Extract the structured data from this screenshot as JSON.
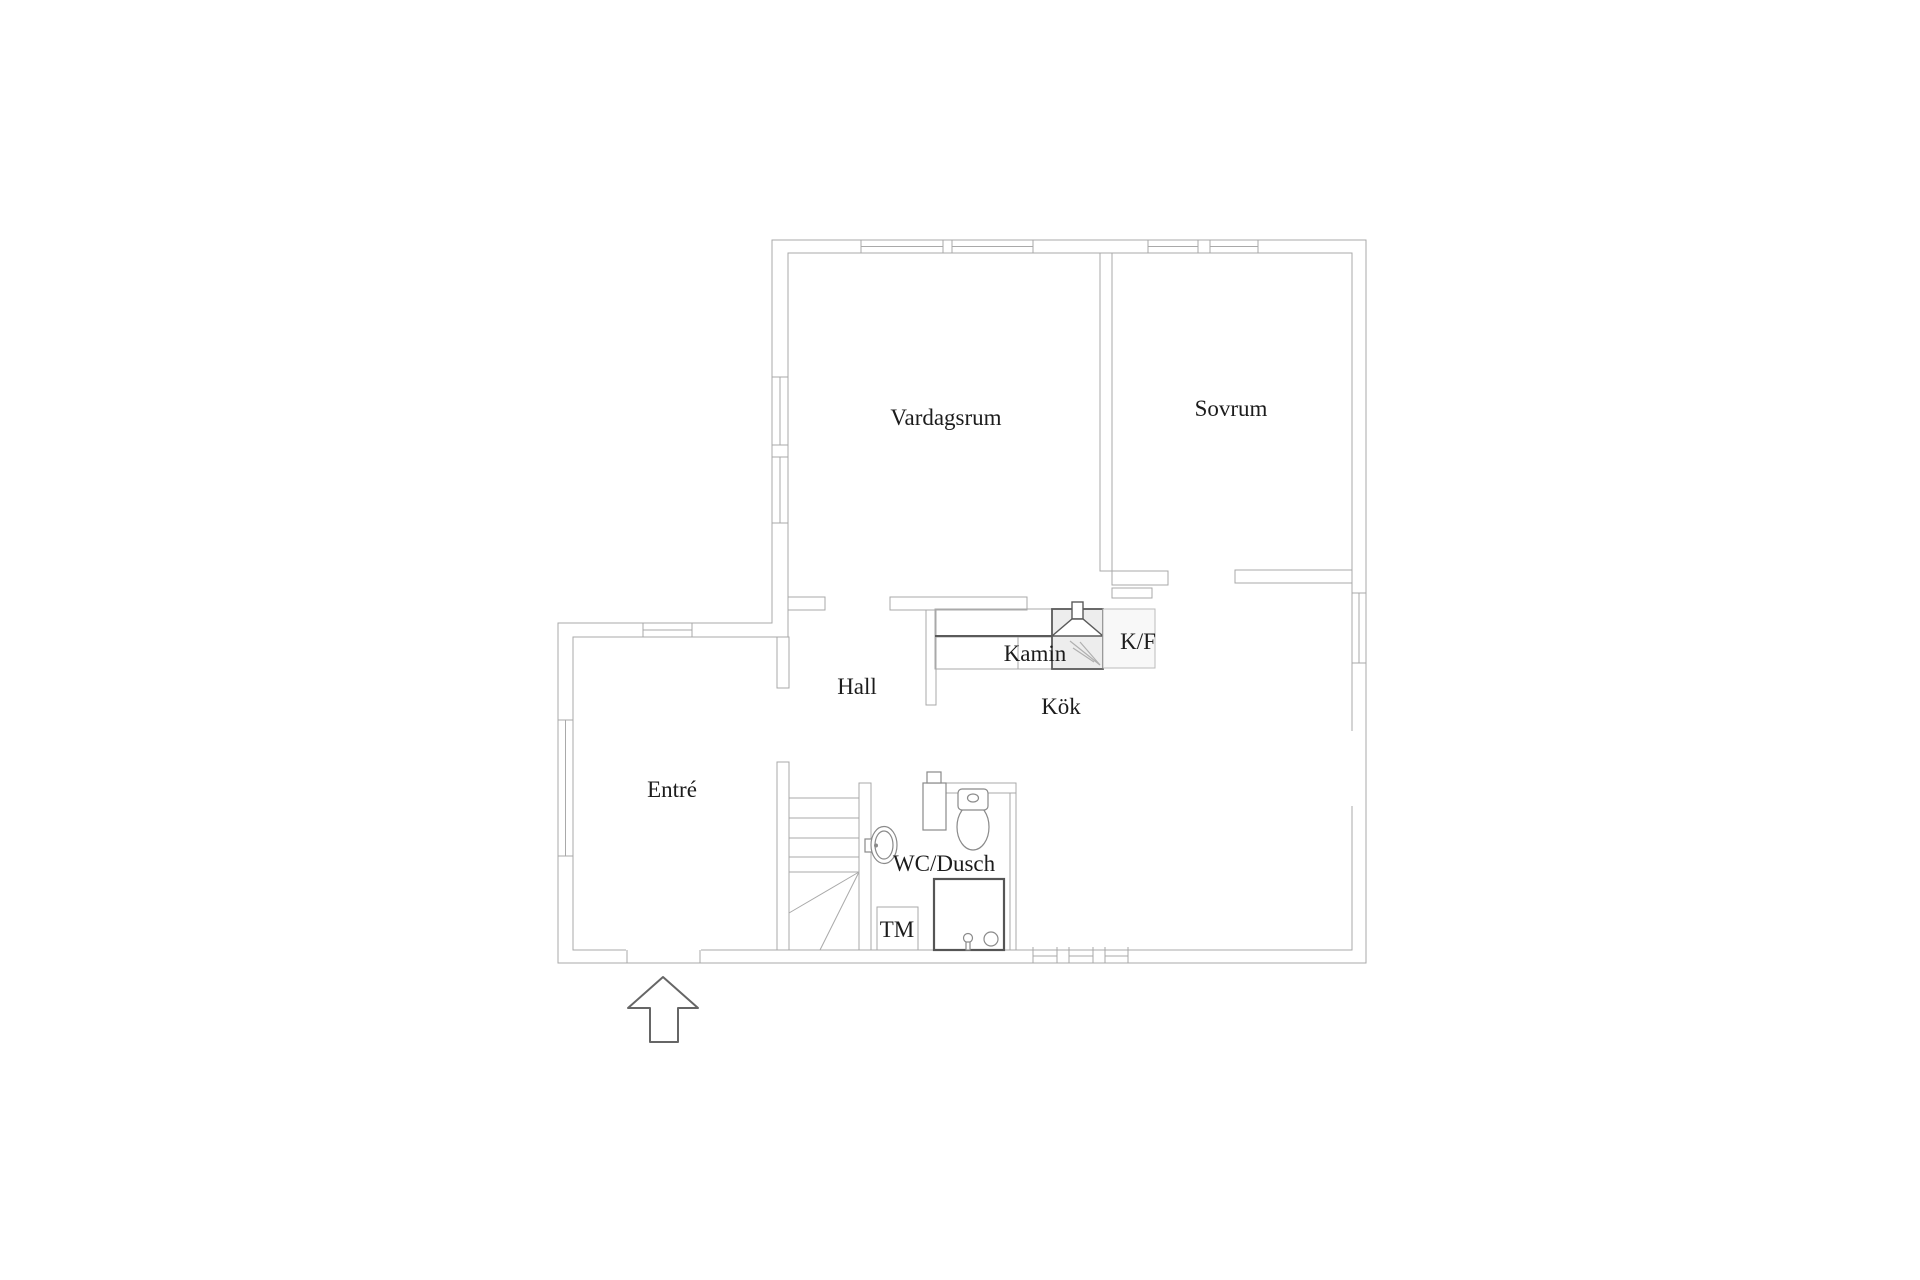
{
  "floorplan": {
    "labels": {
      "vardagsrum": "Vardagsrum",
      "sovrum": "Sovrum",
      "hall": "Hall",
      "kok": "Kök",
      "entre": "Entré",
      "wc_dusch": "WC/Dusch",
      "kamin": "Kamin",
      "kf": "K/F",
      "tm": "TM"
    },
    "entrance_arrow": {
      "direction": "up"
    },
    "colors": {
      "background": "#ffffff",
      "wall_line": "#a9a9a9",
      "fixture_line": "#8a8a8a",
      "dark_line": "#5a5a5a",
      "text": "#1c1c1c",
      "fireplace_fill": "#ededed",
      "arrow_line": "#666666"
    }
  }
}
